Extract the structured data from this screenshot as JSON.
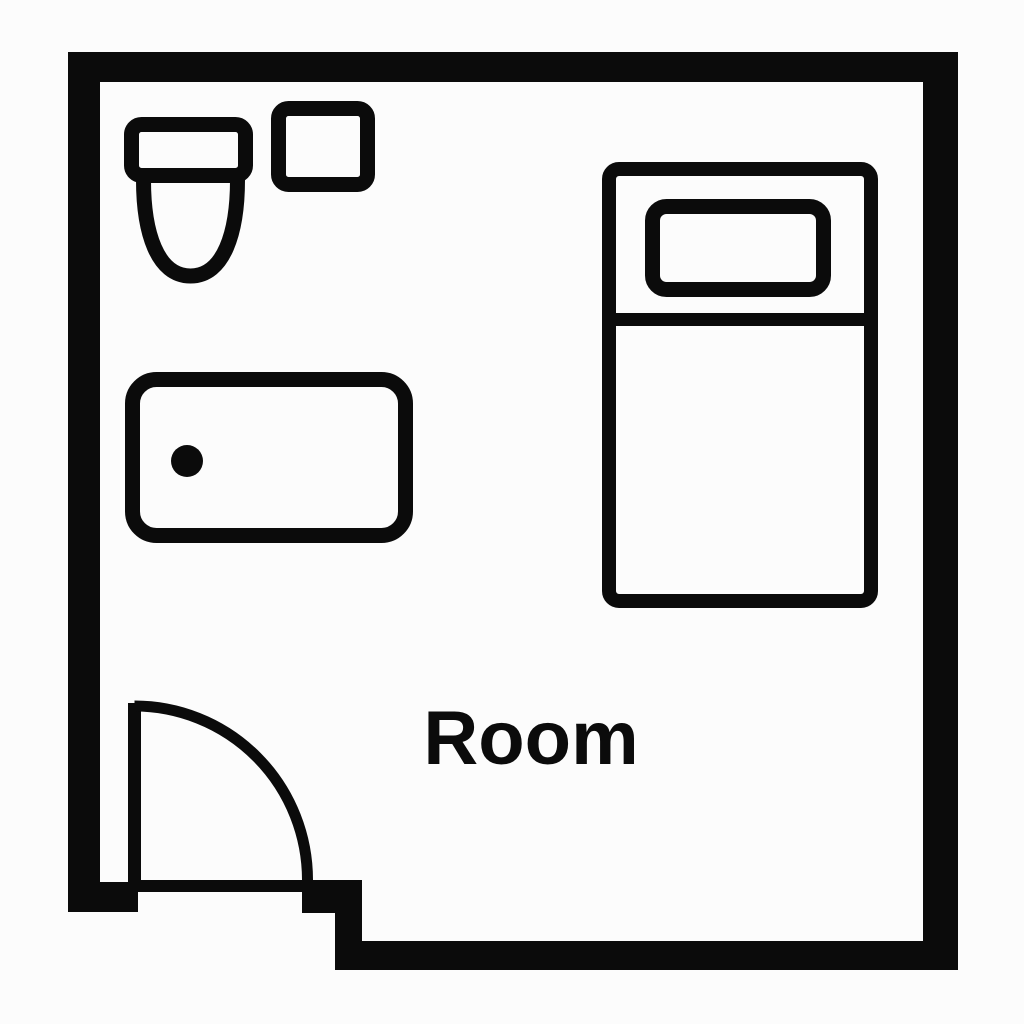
{
  "title": "Room floor plan",
  "room": {
    "label": "Room"
  },
  "colors": {
    "ink": "#0b0b0b",
    "background": "#fcfcfc"
  },
  "objects": [
    {
      "name": "toilet",
      "type": "fixture",
      "location": "top-left"
    },
    {
      "name": "sink",
      "type": "fixture",
      "location": "top-left, right of toilet"
    },
    {
      "name": "bathtub",
      "type": "fixture",
      "location": "left-middle"
    },
    {
      "name": "bed",
      "type": "furniture",
      "location": "right"
    },
    {
      "name": "pillow",
      "type": "furniture",
      "location": "top of bed"
    },
    {
      "name": "door",
      "type": "opening",
      "location": "bottom-left",
      "swing": "quarter-arc inward"
    }
  ]
}
